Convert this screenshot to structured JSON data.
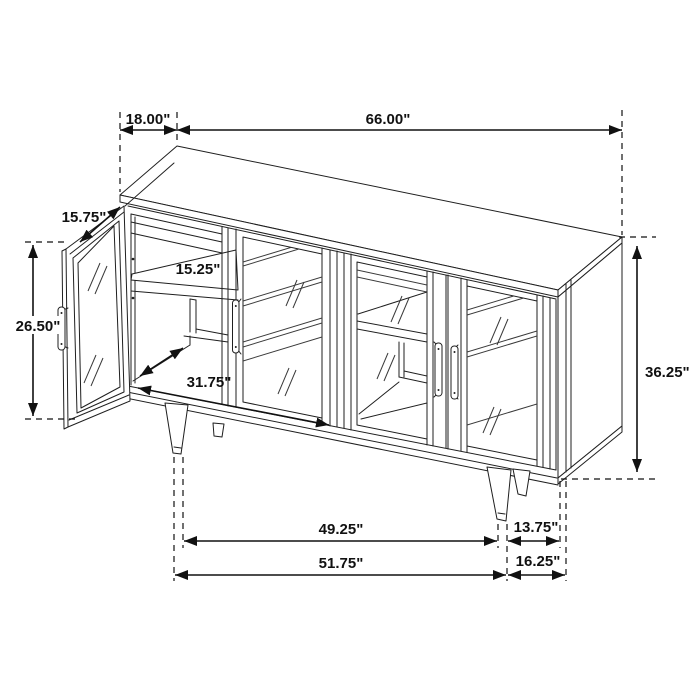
{
  "page": {
    "background": "#ffffff",
    "line_color": "#1f1f1f"
  },
  "diagram": {
    "subject": "Sideboard accent cabinet with glass doors (one door open) on tapered legs — isometric dimension drawing",
    "units": "inches",
    "labels": {
      "top_depth": "18.00\"",
      "top_width": "66.00\"",
      "door_width": "15.75\"",
      "door_height": "26.50\"",
      "interior_depth": "15.25\"",
      "interior_width": "31.75\"",
      "overall_height": "36.25\"",
      "leg_span_inner": "49.25\"",
      "right_overhang": "13.75\"",
      "leg_span_outer": "51.75\"",
      "right_overhang_outer": "16.25\""
    }
  }
}
